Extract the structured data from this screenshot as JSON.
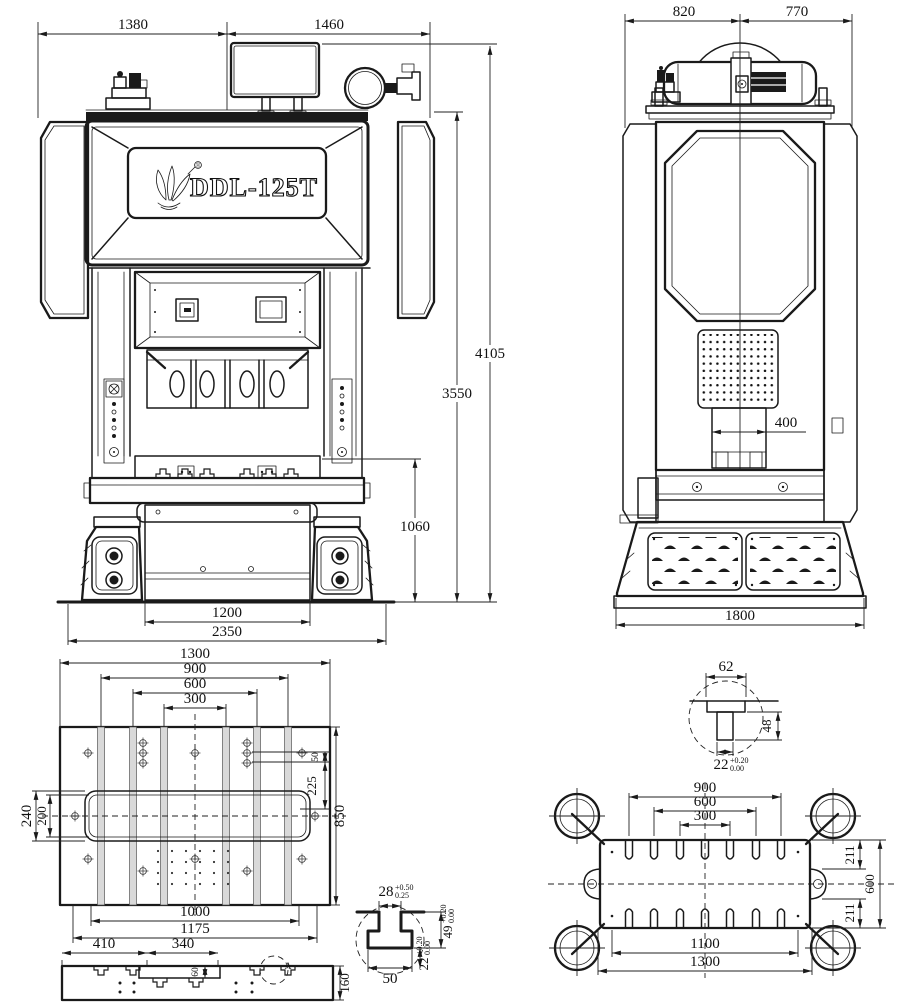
{
  "drawing": {
    "model": "DDL-125T",
    "registered_mark": "®",
    "colors": {
      "ink": "#1a1a1a",
      "background": "#ffffff",
      "slot_fill": "#d9d9d9"
    },
    "front": {
      "d_top_left": "1380",
      "d_top_right": "1460",
      "d_height_overall": "4105",
      "d_height_body": "3550",
      "d_table_height": "1060",
      "d_leg_span": "1200",
      "d_base_width": "2350"
    },
    "side": {
      "d_top_left": "820",
      "d_top_right": "770",
      "d_slide": "400",
      "d_base": "1800"
    },
    "bolster": {
      "d_w1300": "1300",
      "d_w900": "900",
      "d_w600": "600",
      "d_w300": "300",
      "d_240": "240",
      "d_200": "200",
      "d_50": "50",
      "d_225": "225",
      "d_850": "850",
      "d_1000": "1000",
      "d_1175": "1175"
    },
    "section": {
      "d_410": "410",
      "d_340": "340",
      "d_60": "60",
      "d_160": "160",
      "detail": "A"
    },
    "tslot62": {
      "d_62": "62",
      "d_48": "48",
      "d_22": "22",
      "tol_up": "+0.20",
      "tol_dn": "0.00"
    },
    "slide": {
      "d_900": "900",
      "d_600": "600",
      "d_300": "300",
      "d_211_top": "211",
      "d_600_side": "600",
      "d_211_bottom": "211",
      "d_1100": "1100",
      "d_1300": "1300"
    },
    "tslot28": {
      "d_28": "28",
      "tol28_up": "+0.50",
      "tol28_dn": "0.25",
      "d_50": "50",
      "d_49": "49",
      "tol49_up": "+0.20",
      "tol49_dn": "0.00",
      "d_22": "22",
      "tol22_up": "+0.20",
      "tol22_dn": "0.00"
    }
  }
}
